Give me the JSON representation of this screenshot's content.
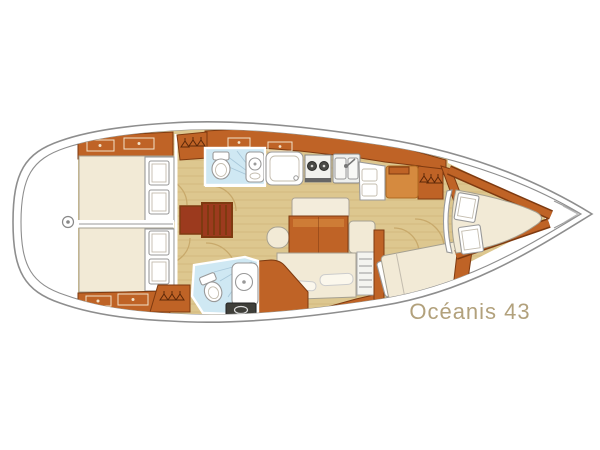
{
  "page": {
    "background": "#ffffff",
    "type": "yacht-interior-floorplan"
  },
  "boat": {
    "model_label": "Océanis 43"
  },
  "icons": {
    "hanging_locker": "clothes-hangers",
    "toilet": "toilet-bowl",
    "sink": "round-sink",
    "stove": "two-burner-stove",
    "double_sink": "double-sink-with-faucet",
    "companionway": "stairs-treads",
    "stern_fitting": "small-circle"
  },
  "colors": {
    "floor": "#ddc78f",
    "floor_line": "#b89a55",
    "wood": "#bf6326",
    "wood_light": "#d58a3f",
    "wood_dark": "#7e3a10",
    "steps": "#9c3a1e",
    "bed": "#f2ead6",
    "bath": "#cfe8f3",
    "bath_line": "#a8c8da",
    "hull_line": "#8e8e8e",
    "panel_dark": "#3f3f3a",
    "label": "#b2a17c"
  }
}
